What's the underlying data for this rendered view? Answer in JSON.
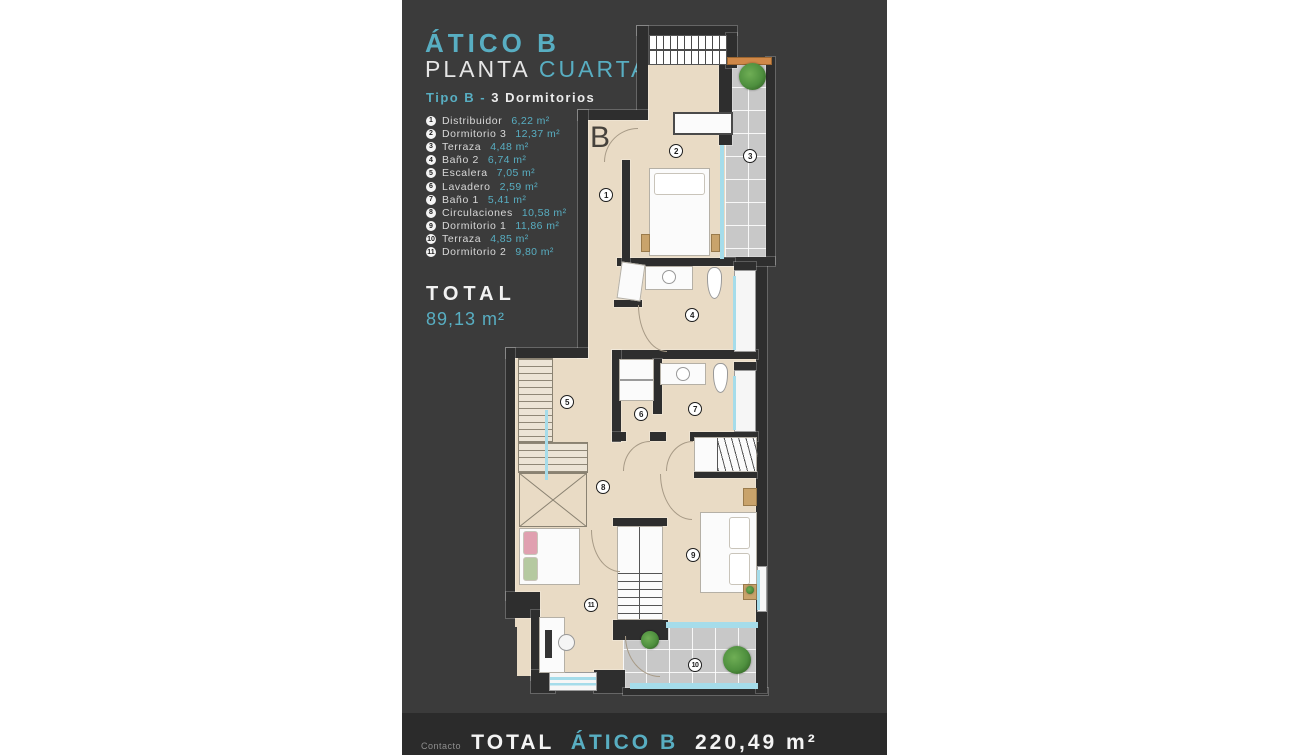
{
  "header": {
    "title": "ÁTICO B",
    "subtitle_word1": "PLANTA",
    "subtitle_word2": "CUARTA",
    "type_label": "Tipo B -",
    "type_value": "3 Dormitorios"
  },
  "rooms": [
    {
      "num": "1",
      "name": "Distribuidor",
      "area": "6,22 m²"
    },
    {
      "num": "2",
      "name": "Dormitorio 3",
      "area": "12,37 m²"
    },
    {
      "num": "3",
      "name": "Terraza",
      "area": "4,48 m²"
    },
    {
      "num": "4",
      "name": "Baño 2",
      "area": "6,74 m²"
    },
    {
      "num": "5",
      "name": "Escalera",
      "area": "7,05 m²"
    },
    {
      "num": "6",
      "name": "Lavadero",
      "area": "2,59 m²"
    },
    {
      "num": "7",
      "name": "Baño 1",
      "area": "5,41 m²"
    },
    {
      "num": "8",
      "name": "Circulaciones",
      "area": "10,58 m²"
    },
    {
      "num": "9",
      "name": "Dormitorio 1",
      "area": "11,86 m²"
    },
    {
      "num": "10",
      "name": "Terraza",
      "area": "4,85 m²"
    },
    {
      "num": "11",
      "name": "Dormitorio 2",
      "area": "9,80 m²"
    }
  ],
  "total": {
    "label": "TOTAL",
    "value": "89,13 m²"
  },
  "footer": {
    "label": "TOTAL",
    "unit_name": "ÁTICO B",
    "value": "220,49 m²",
    "contact": "Contacto"
  },
  "plan": {
    "block_letter": "B"
  },
  "colors": {
    "accent": "#58aec2",
    "panel": "#3b3b3b",
    "bar": "#2b2b2b",
    "floor": "#e9dbc5",
    "tile": "#c8c8c8",
    "window": "#a5dcea",
    "orange": "#d08848",
    "wall": "#2e2e2e",
    "plant": "#4e8f3e"
  }
}
